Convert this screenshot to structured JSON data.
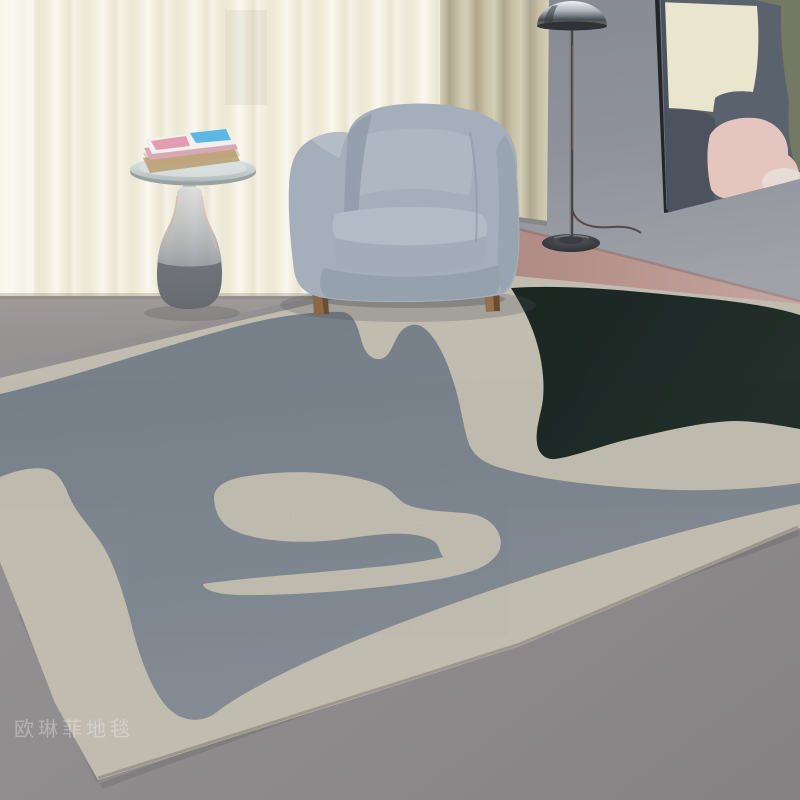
{
  "watermark": {
    "text": "欧琳菲地毯"
  },
  "palette": {
    "wall": "#8b8e99",
    "floor_gray": "#8e8b8c",
    "floor_pink": "#b28c85",
    "floor_light": "#beb8ae",
    "curtain_sheer": "#f3f0e4",
    "curtain_beige": "#c3bca2",
    "rug_gray": "#98a2ae",
    "rug_cream": "#ece7d8",
    "rug_green": "#24332e",
    "armchair_fabric": "#a5afbb",
    "wood_leg": "#8d6847",
    "lamp_chrome": "#c6cbd0",
    "lamp_base": "#2c2f33",
    "table_glass": "#9aa0a8",
    "brass_accent": "#c08f3f",
    "magazine_pink": "#d8a8b4",
    "magazine_blue": "#5bb7e3",
    "art_pink": "#e4c6bf",
    "art_cream": "#eae6cd",
    "art_slate": "#4c535e",
    "art_olive": "#747963"
  }
}
